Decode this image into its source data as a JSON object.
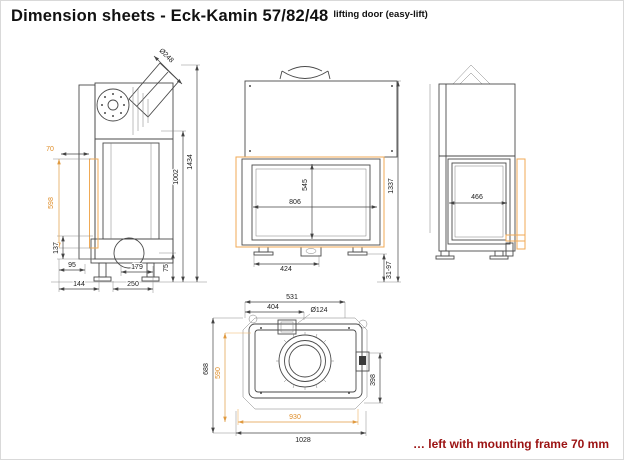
{
  "title": {
    "main": "Dimension sheets - Eck-Kamin 57/82/48",
    "sub": "lifting door (easy-lift)"
  },
  "note": "… left with mounting frame 70 mm",
  "colors": {
    "accent_orange_text": "#de8b25",
    "accent_orange_line": "#f0aa55",
    "note_red": "#9b1212",
    "drawing_line": "#4a4a4a"
  },
  "views": {
    "side": {
      "dims": {
        "flue_diameter": "Ø248",
        "frame_depth": "70",
        "frame_height": "598",
        "base_height": "137",
        "d95": "95",
        "d144": "144",
        "d179": "179",
        "d250": "250",
        "leg_height": "75",
        "body_height": "1002",
        "total_height": "1434"
      }
    },
    "front": {
      "dims": {
        "door_height": "545",
        "door_width": "806",
        "base_width": "424",
        "total_height": "1337",
        "leg_adjust": "31-97"
      }
    },
    "right": {
      "dims": {
        "door_width": "466"
      }
    },
    "top": {
      "dims": {
        "d531": "531",
        "d404": "404",
        "air_inlet_diameter": "Ø124",
        "total_depth": "688",
        "frame_depth": "590",
        "frame_width": "930",
        "total_width": "1028",
        "d398": "398"
      }
    }
  }
}
